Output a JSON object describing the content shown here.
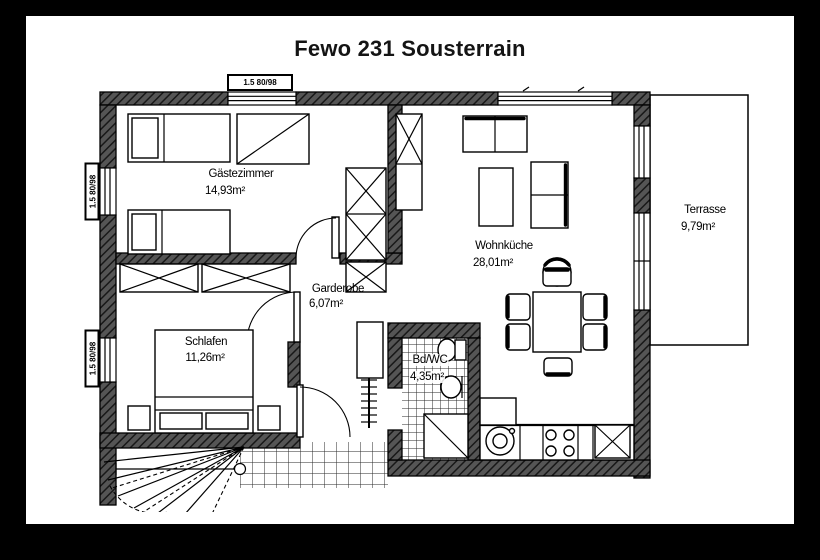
{
  "title": "Fewo 231 Sousterrain",
  "rooms": {
    "gaestezimmer": {
      "name": "Gästezimmer",
      "area": "14,93m²"
    },
    "wohnkueche": {
      "name": "Wohnküche",
      "area": "28,01m²"
    },
    "garderobe": {
      "name": "Garderobe",
      "area": "6,07m²"
    },
    "schlafen": {
      "name": "Schlafen",
      "area": "11,26m²"
    },
    "bad_wc": {
      "name": "Bd/WC",
      "area": "4,35m²"
    },
    "terrasse": {
      "name": "Terrasse",
      "area": "9,79m²"
    }
  },
  "window_labels": {
    "top": "1.5 80/98",
    "left_upper": "1.5 80/98",
    "left_lower": "1.5 80/98"
  },
  "colors": {
    "frame": "#000000",
    "paper": "#ffffff",
    "ink": "#111111",
    "wall_hatch": "#555555"
  }
}
